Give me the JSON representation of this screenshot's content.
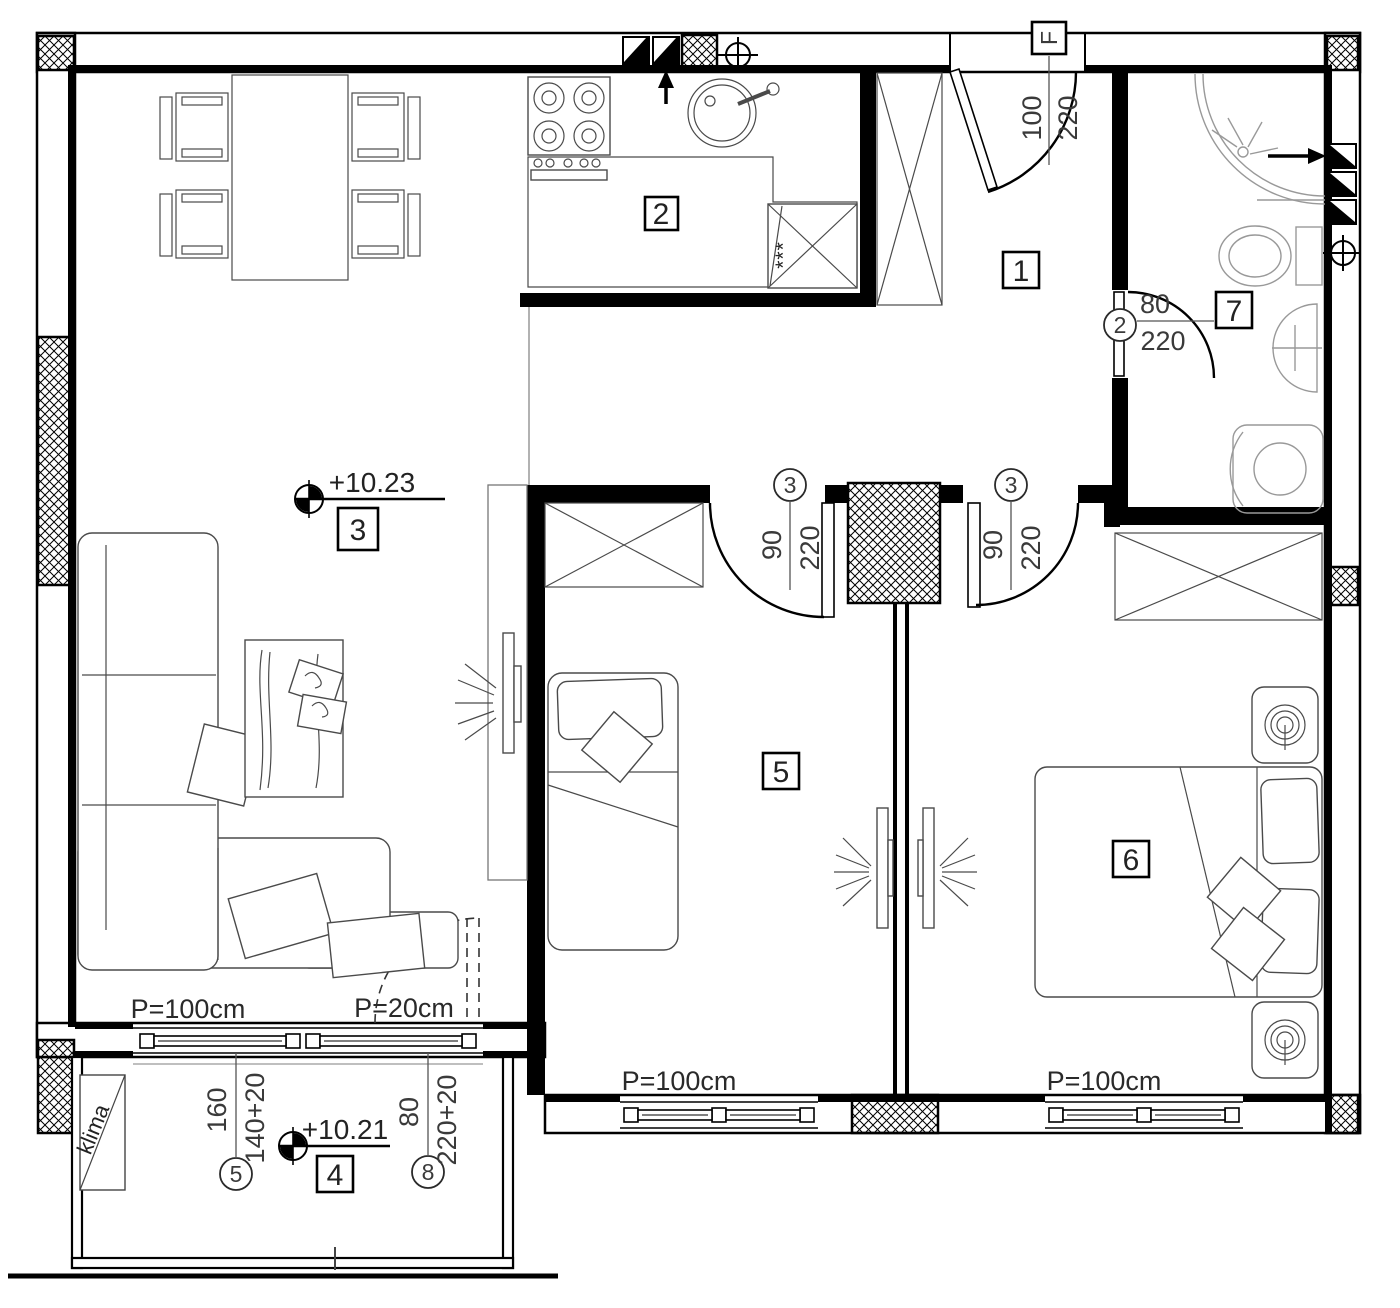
{
  "rooms": {
    "r1": "1",
    "r2": "2",
    "r3": "3",
    "r4": "4",
    "r5": "5",
    "r6": "6",
    "r7": "7"
  },
  "levels": {
    "living": "+10.23",
    "balcony": "+10.21"
  },
  "doors": {
    "entrance": {
      "tag": "F",
      "w": "100",
      "h": "220"
    },
    "bathroom": {
      "tag": "2",
      "w": "80",
      "h": "220"
    },
    "room5": {
      "tag": "3",
      "w": "90",
      "h": "220"
    },
    "room6": {
      "tag": "3",
      "w": "90",
      "h": "220"
    }
  },
  "openings": {
    "balcony_window": {
      "tag": "5",
      "w": "160",
      "h": "140+20"
    },
    "balcony_door": {
      "tag": "8",
      "w": "80",
      "h": "220+20"
    }
  },
  "parapets": {
    "balcony_window": "P=100cm",
    "balcony_door": "P=20cm",
    "room5_window": "P=100cm",
    "room6_window": "P=100cm"
  },
  "annotations": {
    "klima": "klima",
    "freezer": "***"
  }
}
